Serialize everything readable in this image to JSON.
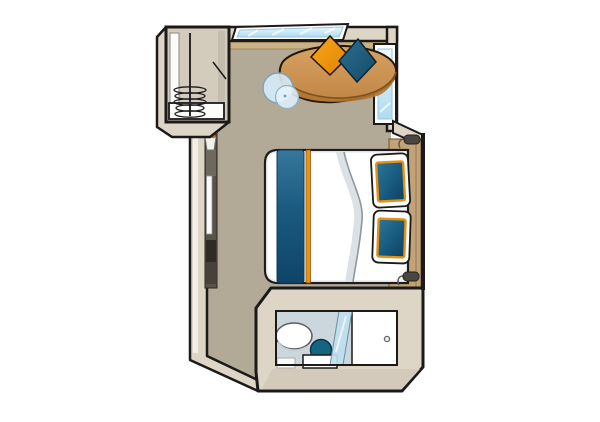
{
  "scene": {
    "title": "cabin-floor-plan",
    "type": "floor-plan-illustration",
    "areas": {
      "wardrobe": {
        "items": [
          "hanging-rod",
          "coat-hangers",
          "shelf",
          "side-panel"
        ]
      },
      "sitting_area": {
        "items": [
          "panorama-window",
          "window-ledge",
          "sofa",
          "cushion-orange",
          "cushion-teal",
          "glass-side-table",
          "side-window"
        ]
      },
      "sleeping_area": {
        "items": [
          "double-bed",
          "duvet-fold",
          "bed-runner-teal",
          "bed-runner-orange-trim",
          "pillow-upper",
          "pillow-lower",
          "headboard-ledge",
          "reading-lamp-upper",
          "reading-lamp-lower",
          "vanity-console",
          "vanity-mirror",
          "flower-pot"
        ]
      },
      "bathroom": {
        "items": [
          "washbasin",
          "toilet",
          "shower-glass-partition",
          "bath-mat",
          "entrance-door",
          "door-knob"
        ]
      }
    }
  },
  "colors": {
    "outline": "#1b1a18",
    "wall": "#ddd5c6",
    "wall_side": "#d3cabb",
    "wall_highlight": "#f2efe8",
    "floor": "#b3a997",
    "ledge": "#c9b183",
    "headboard": "#c2a377",
    "window_glass": "#cfe9f7",
    "window_frame": "#ffffff",
    "closet_inner": "#d3ccbd",
    "sofa_top": "#cf9752",
    "sofa_base": "#b0772f",
    "cushion_orange": "#f29100",
    "cushion_teal": "#1c5a7c",
    "table_glass": "#d6ecf8",
    "table_glass_small": "#e2f2fa",
    "bed_white": "#ffffff",
    "runner_trim_orange": "#ea9212",
    "pillow_trim_orange": "#e59114",
    "duvet_shadow": "#d8dee2",
    "bath_floor": "#ccd7dd",
    "toilet_teal": "#156480",
    "shower_glass": "#bfdeee",
    "door_white": "#ffffff",
    "vanity_dark": "#57524a",
    "vanity_mid": "#6e685e",
    "vanity_box1": "#2e2a25",
    "vanity_box2": "#46423b",
    "mirror_white": "#fafaf8",
    "flower_orange": "#ef8e0c",
    "lamp_gray": "#4b463f",
    "mat_white": "#fafafa"
  }
}
